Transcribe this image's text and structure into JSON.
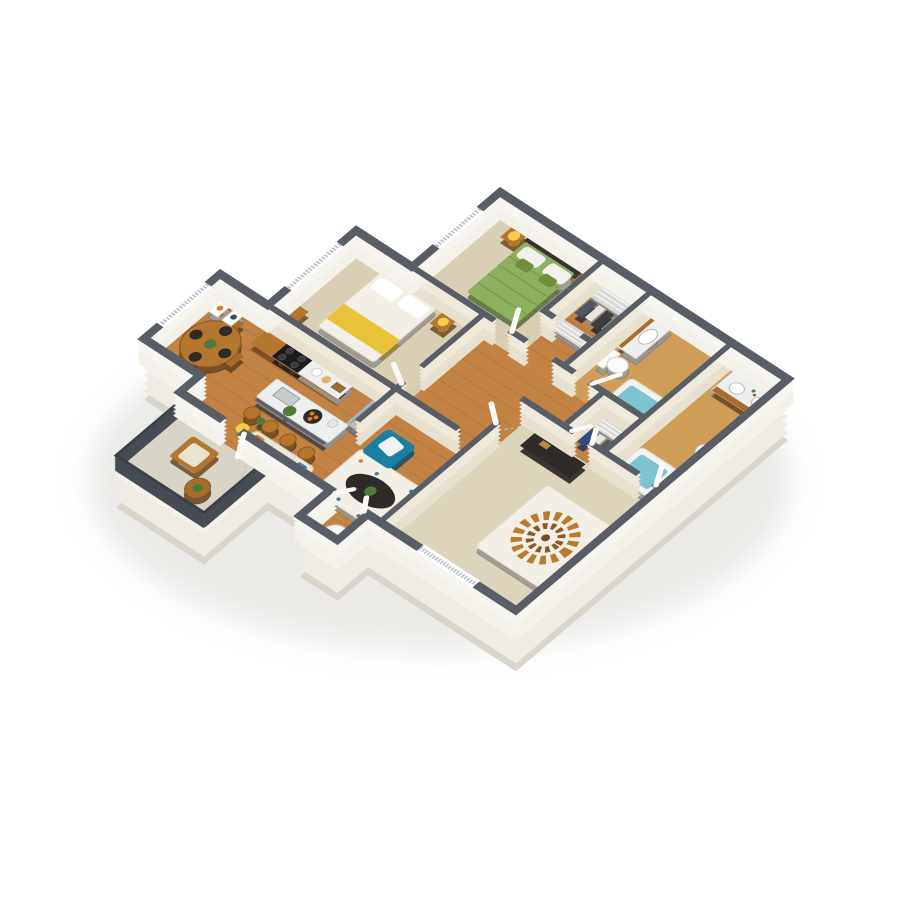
{
  "scene": {
    "view": "isometric-3d-floorplan",
    "rooms": [
      "bedroom-north",
      "hall-closet",
      "bathroom-north",
      "bedroom-west",
      "kitchen",
      "dining-nook",
      "living-room",
      "hallway",
      "master-walk-in-closet",
      "master-bathroom",
      "master-bedroom",
      "utility-closet",
      "balcony"
    ],
    "furniture": {
      "bedroom_north": [
        "bed-green",
        "nightstand-left",
        "nightstand-right",
        "lamp",
        "lamp",
        "window-blinds"
      ],
      "bedroom_west": [
        "bed-white-yellow-throw",
        "nightstand",
        "lamp",
        "dresser",
        "window-blinds"
      ],
      "kitchen": [
        "range",
        "counter-marble",
        "fridge",
        "island-sink",
        "bar-stools-x4",
        "fruit-plate",
        "plant"
      ],
      "dining_nook": [
        "round-table",
        "chairs-x4",
        "place-settings",
        "window-blinds",
        "art-frames"
      ],
      "living_room": [
        "sofa",
        "armchair-teal",
        "coffee-table-oval",
        "area-rug",
        "table-lamp",
        "plant"
      ],
      "hallway": [
        "console-table"
      ],
      "bathroom_north": [
        "vanity",
        "sink",
        "toilet",
        "bathtub",
        "tile-surround"
      ],
      "master_bathroom": [
        "double-vanity",
        "sinks-x2",
        "toilet",
        "bathtub"
      ],
      "closets": [
        "wire-shelving",
        "hanging-clothes"
      ],
      "master_bedroom": [
        "bed-medallion",
        "headboard",
        "nightstands-x2",
        "lamps-x2",
        "dresser",
        "window-blinds"
      ],
      "utility_closet": [
        "water-heater"
      ],
      "balcony": [
        "railing",
        "patio-chair",
        "side-table",
        "plant"
      ]
    }
  },
  "colors": {
    "background": "#ffffff",
    "wall_top": "#585d66",
    "wall_side_interior": "#e7e0cf",
    "wall_side_exterior": "#f3f1ea",
    "base_side": "#edebe3",
    "base_edge": "#d8d5cb",
    "shadow": "#d9d8d3",
    "wood_floor": "#c28243",
    "wood_plank_line": "#9e662a",
    "bath_floor": "#cf9d58",
    "carpet": "#d8cfb5",
    "carpet_master": "#ddd4bc",
    "balcony_floor": "#d8d4c8",
    "wood_cabinet": "#b5762f",
    "wood_cabinet_dark": "#8a5a22",
    "marble": "#edefee",
    "stainless": "#b9bcbe",
    "range_black": "#1d1d1f",
    "dark_furniture": "#2e2a27",
    "green_bedspread": "#8fb05e",
    "green_pillow": "#6f8f3f",
    "white_linen": "#f3efe6",
    "yellow_accent": "#e8c33a",
    "lamp_yellow": "#f3cd4a",
    "teal_chair": "#1b7ea3",
    "tub_water": "#7cc4cf",
    "porcelain": "#fbfbf9",
    "rug": "#f3efe6",
    "railing": "#3c4148",
    "plant_green": "#4e7b3a",
    "orange_fruit": "#e07b28",
    "wire_shelf": "#d9d9d6",
    "window_white": "#ffffff",
    "blinds_line": "#b9c2c8",
    "door_white": "#fafaf7"
  }
}
